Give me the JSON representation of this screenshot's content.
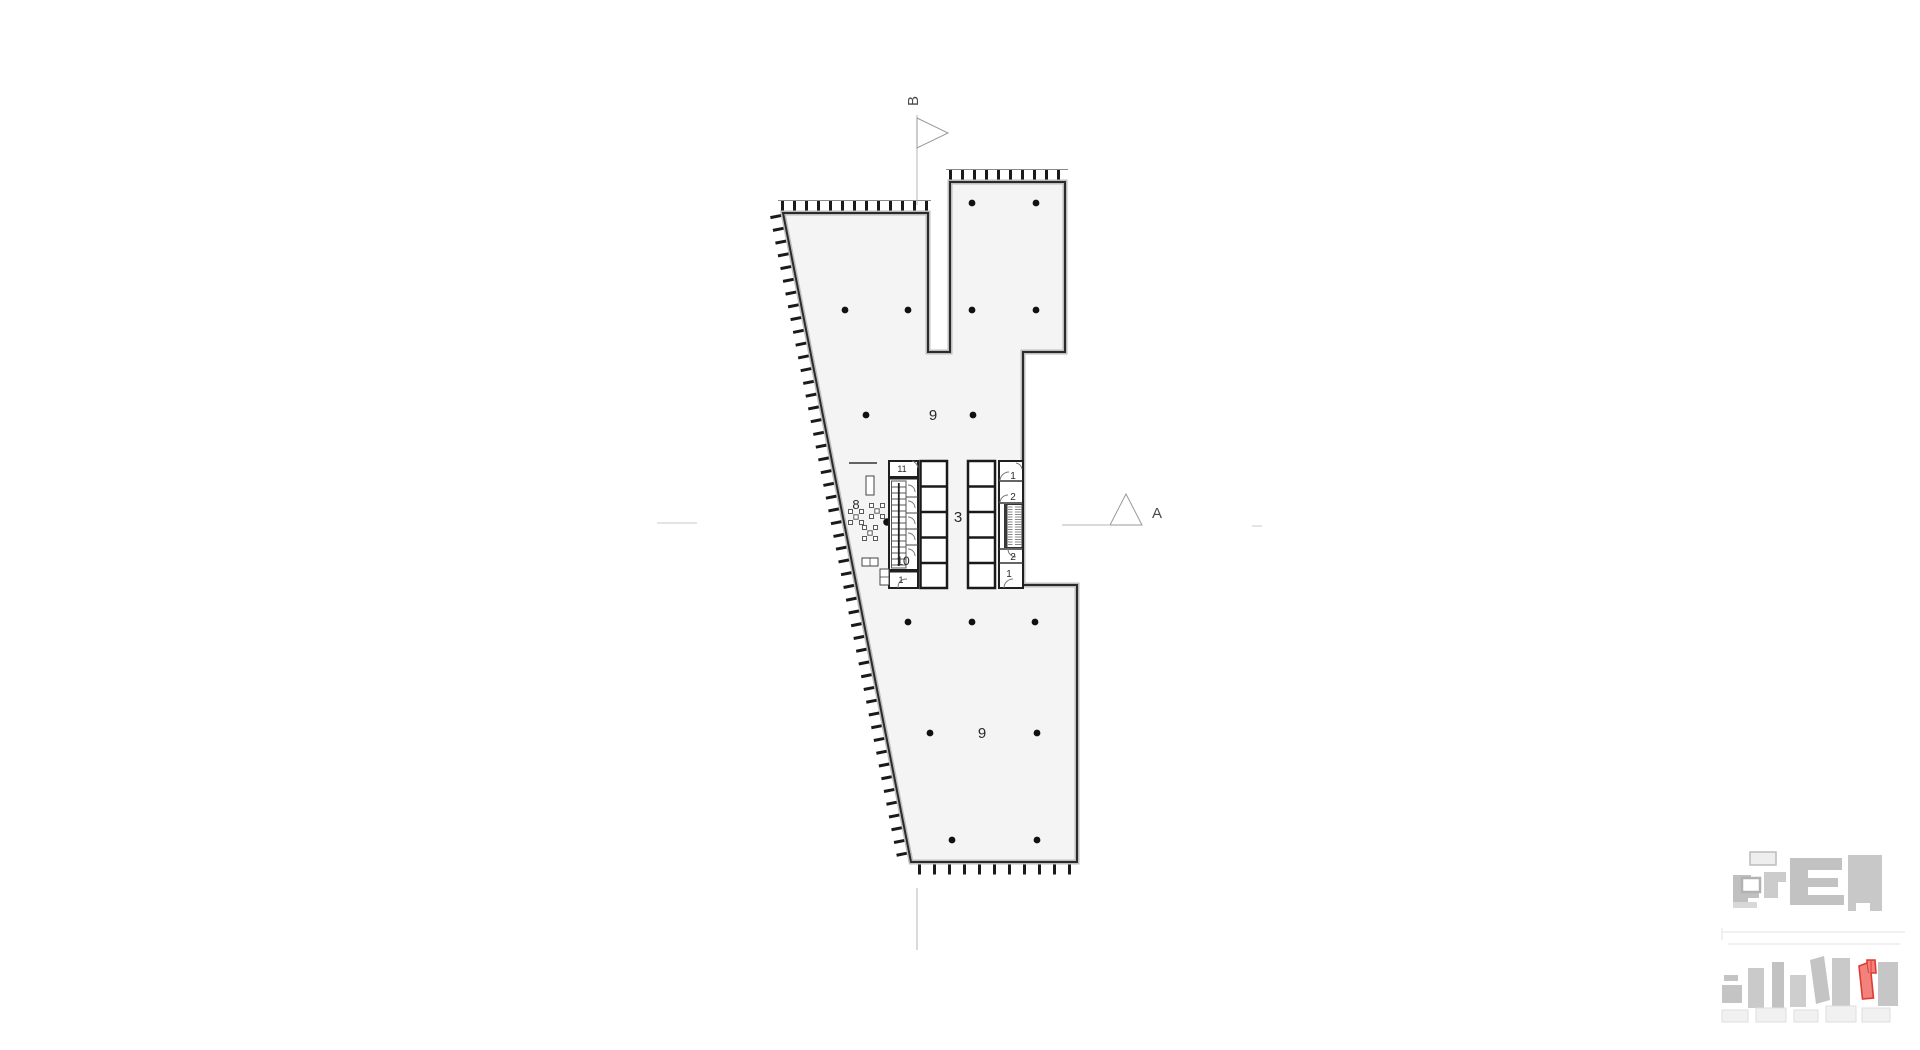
{
  "drawing": {
    "type": "architectural floor plan",
    "room_labels": [
      {
        "id": "open-office-upper",
        "text": "9"
      },
      {
        "id": "open-office-lower",
        "text": "9"
      },
      {
        "id": "core-lobby",
        "text": "3"
      },
      {
        "id": "lounge",
        "text": "8"
      },
      {
        "id": "wc",
        "text": "10"
      },
      {
        "id": "room-eleven",
        "text": "11"
      },
      {
        "id": "stair-left-bottom",
        "text": "1"
      },
      {
        "id": "stair-right-top",
        "text": "1"
      },
      {
        "id": "room-two-top",
        "text": "2"
      },
      {
        "id": "room-two-bottom",
        "text": "2"
      },
      {
        "id": "stair-right-bottom",
        "text": "1"
      }
    ],
    "section_markers": [
      {
        "id": "section-a",
        "label": "A"
      },
      {
        "id": "section-b",
        "label": "B"
      }
    ],
    "colors": {
      "floor_fill": "#f4f4f4",
      "wall": "#2b2b2b",
      "wall_inner": "#bdbdbd",
      "thin_line": "#9b9b9b",
      "hatch": "#1a1a1a",
      "locator_gray": "#c5c5c5",
      "locator_gray_light": "#dedede",
      "locator_red_fill": "#f2827c",
      "locator_red_stroke": "#de3b33"
    }
  }
}
